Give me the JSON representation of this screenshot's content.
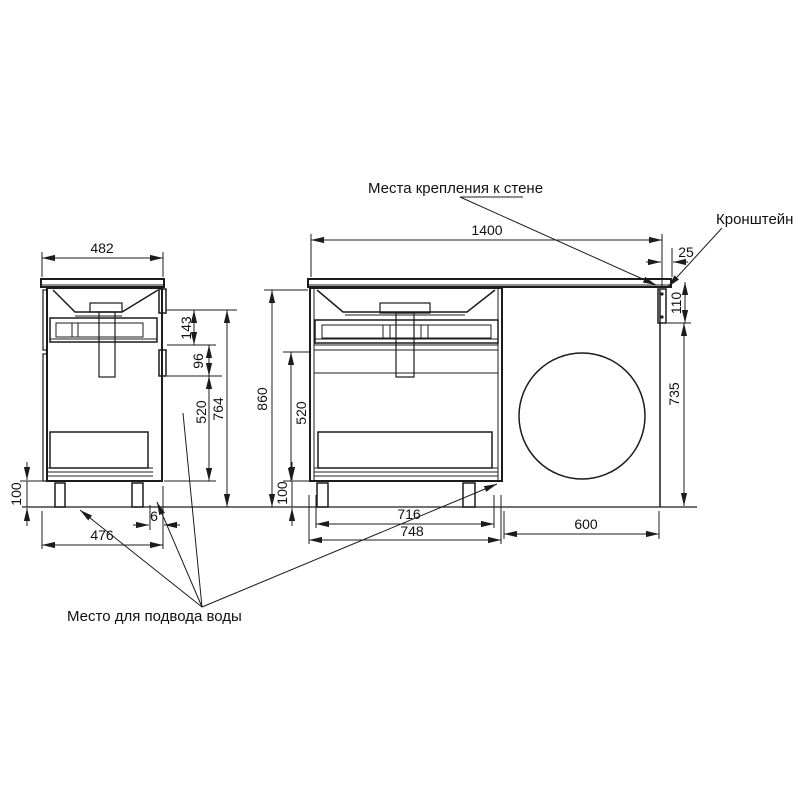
{
  "page": {
    "background": "#ffffff",
    "line_color": "#1c1c1c"
  },
  "labels": {
    "wall_mount": "Места крепления к стене",
    "bracket": "Кронштейн",
    "water_supply": "Место для подвода воды"
  },
  "side_view": {
    "width_top": "482",
    "depth_bottom": "476",
    "back_gap": "6",
    "leg_height": "100",
    "top_offset": "143",
    "inlet_height": "96",
    "lower_section": "520",
    "body_height": "764"
  },
  "front_view": {
    "total_width": "1400",
    "bracket_offset": "25",
    "bracket_drop": "110",
    "right_clearance": "735",
    "total_height": "860",
    "lower_section": "520",
    "leg_height": "100",
    "inner_width": "716",
    "cabinet_width": "748",
    "machine_space": "600"
  }
}
